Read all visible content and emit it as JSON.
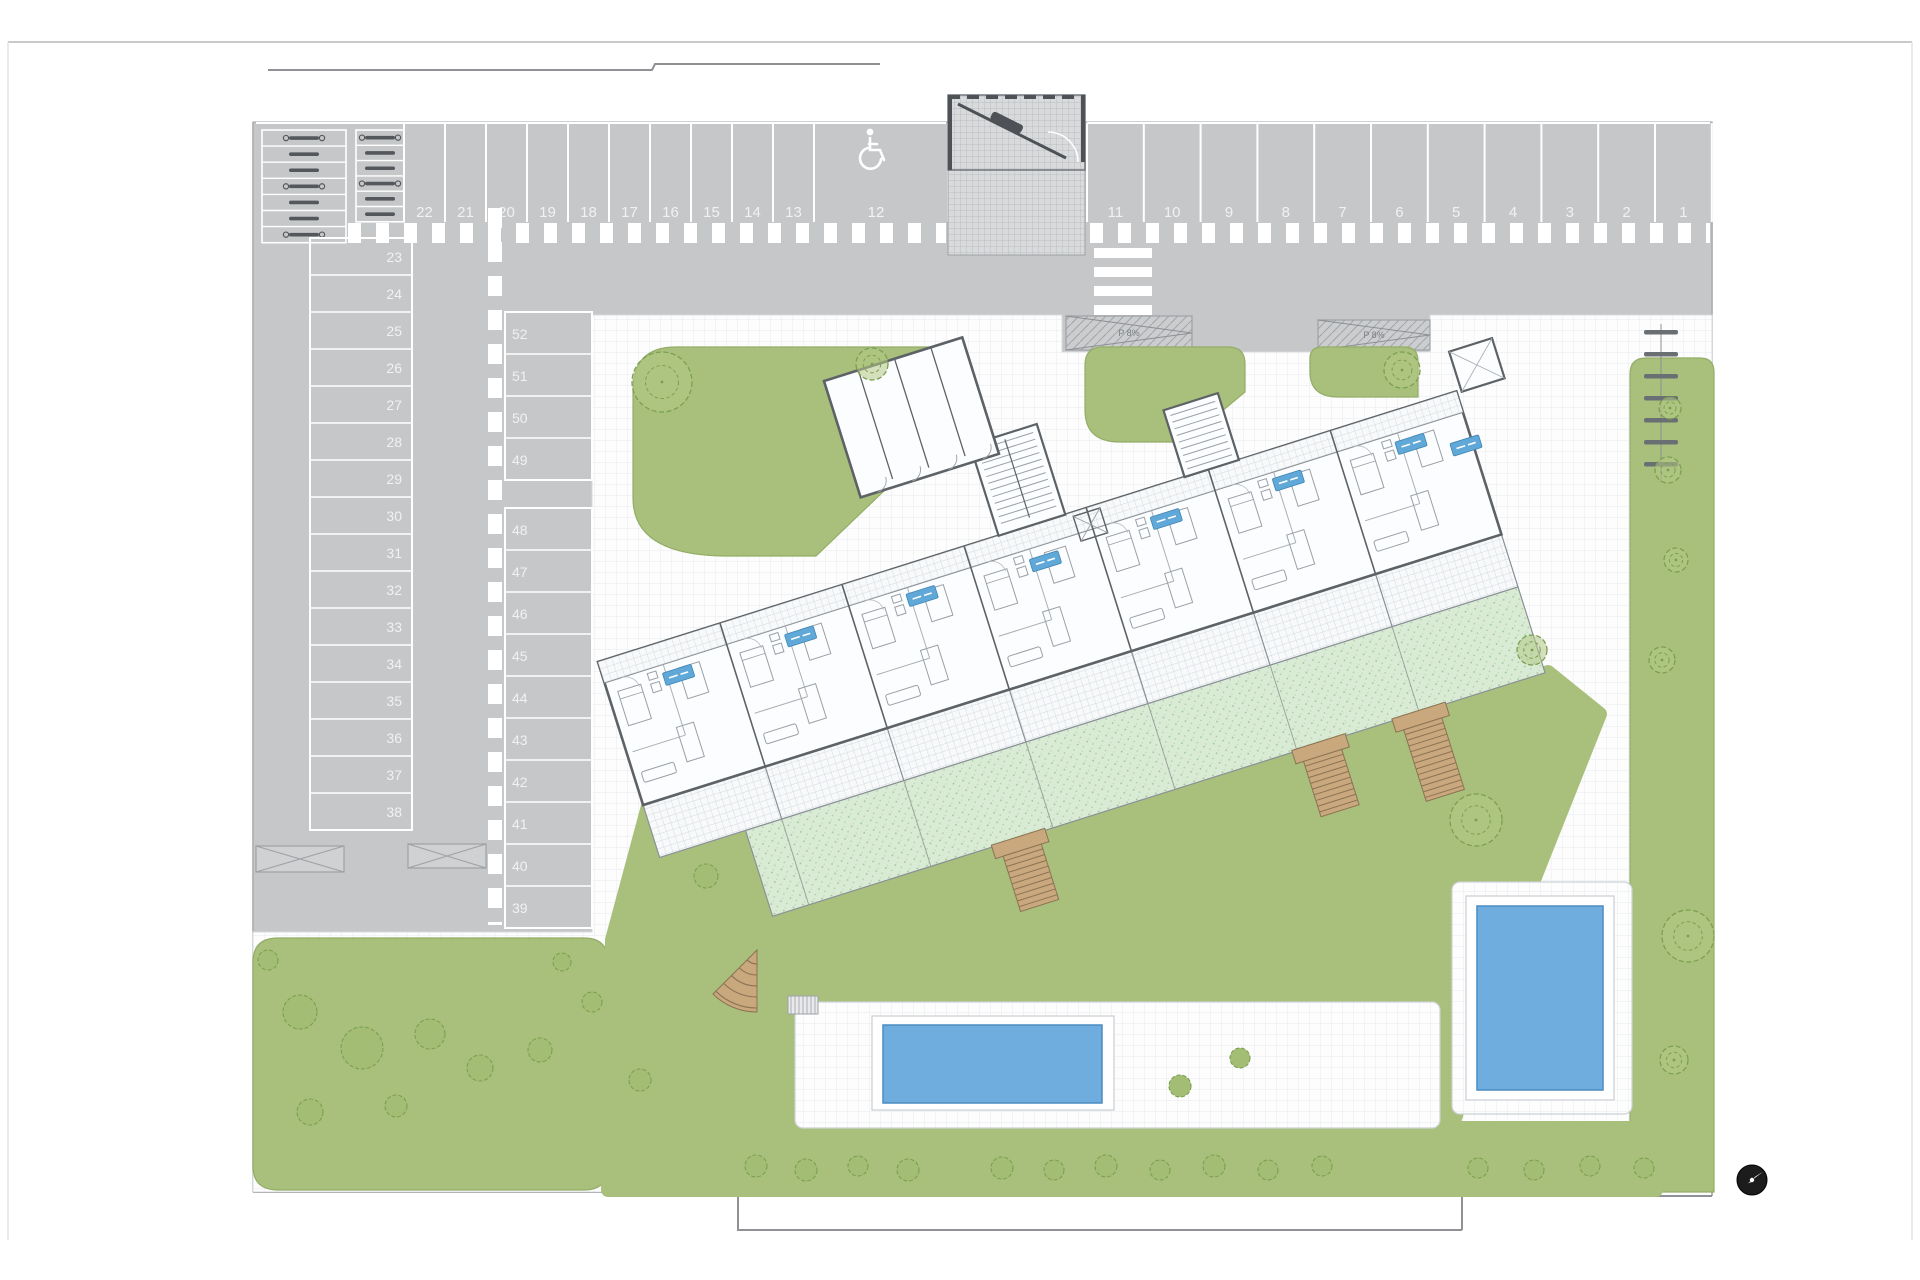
{
  "site_plan": {
    "parking": {
      "top_row_left_numbers": [
        "22",
        "21",
        "20",
        "19",
        "18",
        "17",
        "16",
        "15",
        "14",
        "13"
      ],
      "accessible_space_number": "12",
      "top_row_right_numbers": [
        "11",
        "10",
        "9",
        "8",
        "7",
        "6",
        "5",
        "4",
        "3",
        "2",
        "1"
      ],
      "left_column_numbers": [
        "23",
        "24",
        "25",
        "26",
        "27",
        "28",
        "29",
        "30",
        "31",
        "32",
        "33",
        "34",
        "35",
        "36",
        "37",
        "38"
      ],
      "middle_column_numbers": [
        "52",
        "51",
        "50",
        "49",
        "48",
        "47",
        "46",
        "45",
        "44",
        "43",
        "42",
        "41",
        "40",
        "39"
      ]
    },
    "ramps": [
      {
        "label": "P 8%"
      },
      {
        "label": "P 8%"
      }
    ],
    "icons": {
      "accessible_parking": "wheelchair-symbol",
      "compass": "north-arrow"
    },
    "colors": {
      "asphalt": "#c6c7c9",
      "lawn": "#a9c07c",
      "private_garden": "#d9ebd5",
      "pool_water": "#6fadde",
      "wood_stairs": "#c9a87d",
      "building_wall": "#5d6266",
      "unit_tag_blue": "#5fa8d8",
      "marking_white": "#ffffff"
    }
  }
}
